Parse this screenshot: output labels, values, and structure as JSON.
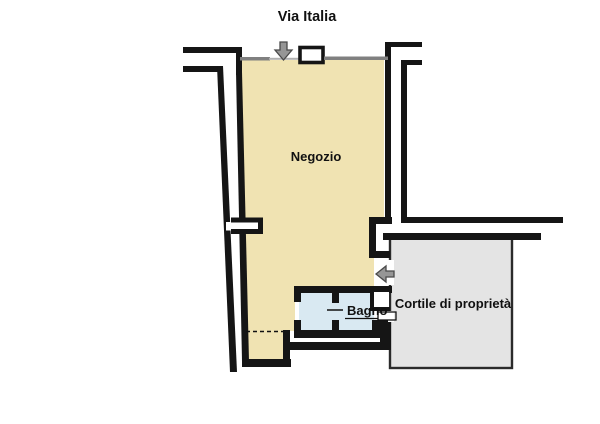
{
  "title": "Via Italia",
  "rooms": {
    "negozio": {
      "label": "Negozio",
      "fill": "#F0E3B2"
    },
    "bagno": {
      "label": "Bagno",
      "fill": "#D9E9F2"
    },
    "cortile": {
      "label": "Cortile di proprietà",
      "fill": "#E4E4E4"
    }
  },
  "colors": {
    "wall": "#151515",
    "storefront_line": "#808080",
    "threshold_line": "#B0B0B0",
    "arrow_fill": "#969696",
    "arrow_border": "#4A4A4A",
    "cortile_border": "#2B2B2B",
    "background": "#FFFFFF"
  },
  "icons": {
    "street_entrance": "arrow-down-icon",
    "courtyard_entrance": "arrow-left-icon"
  }
}
